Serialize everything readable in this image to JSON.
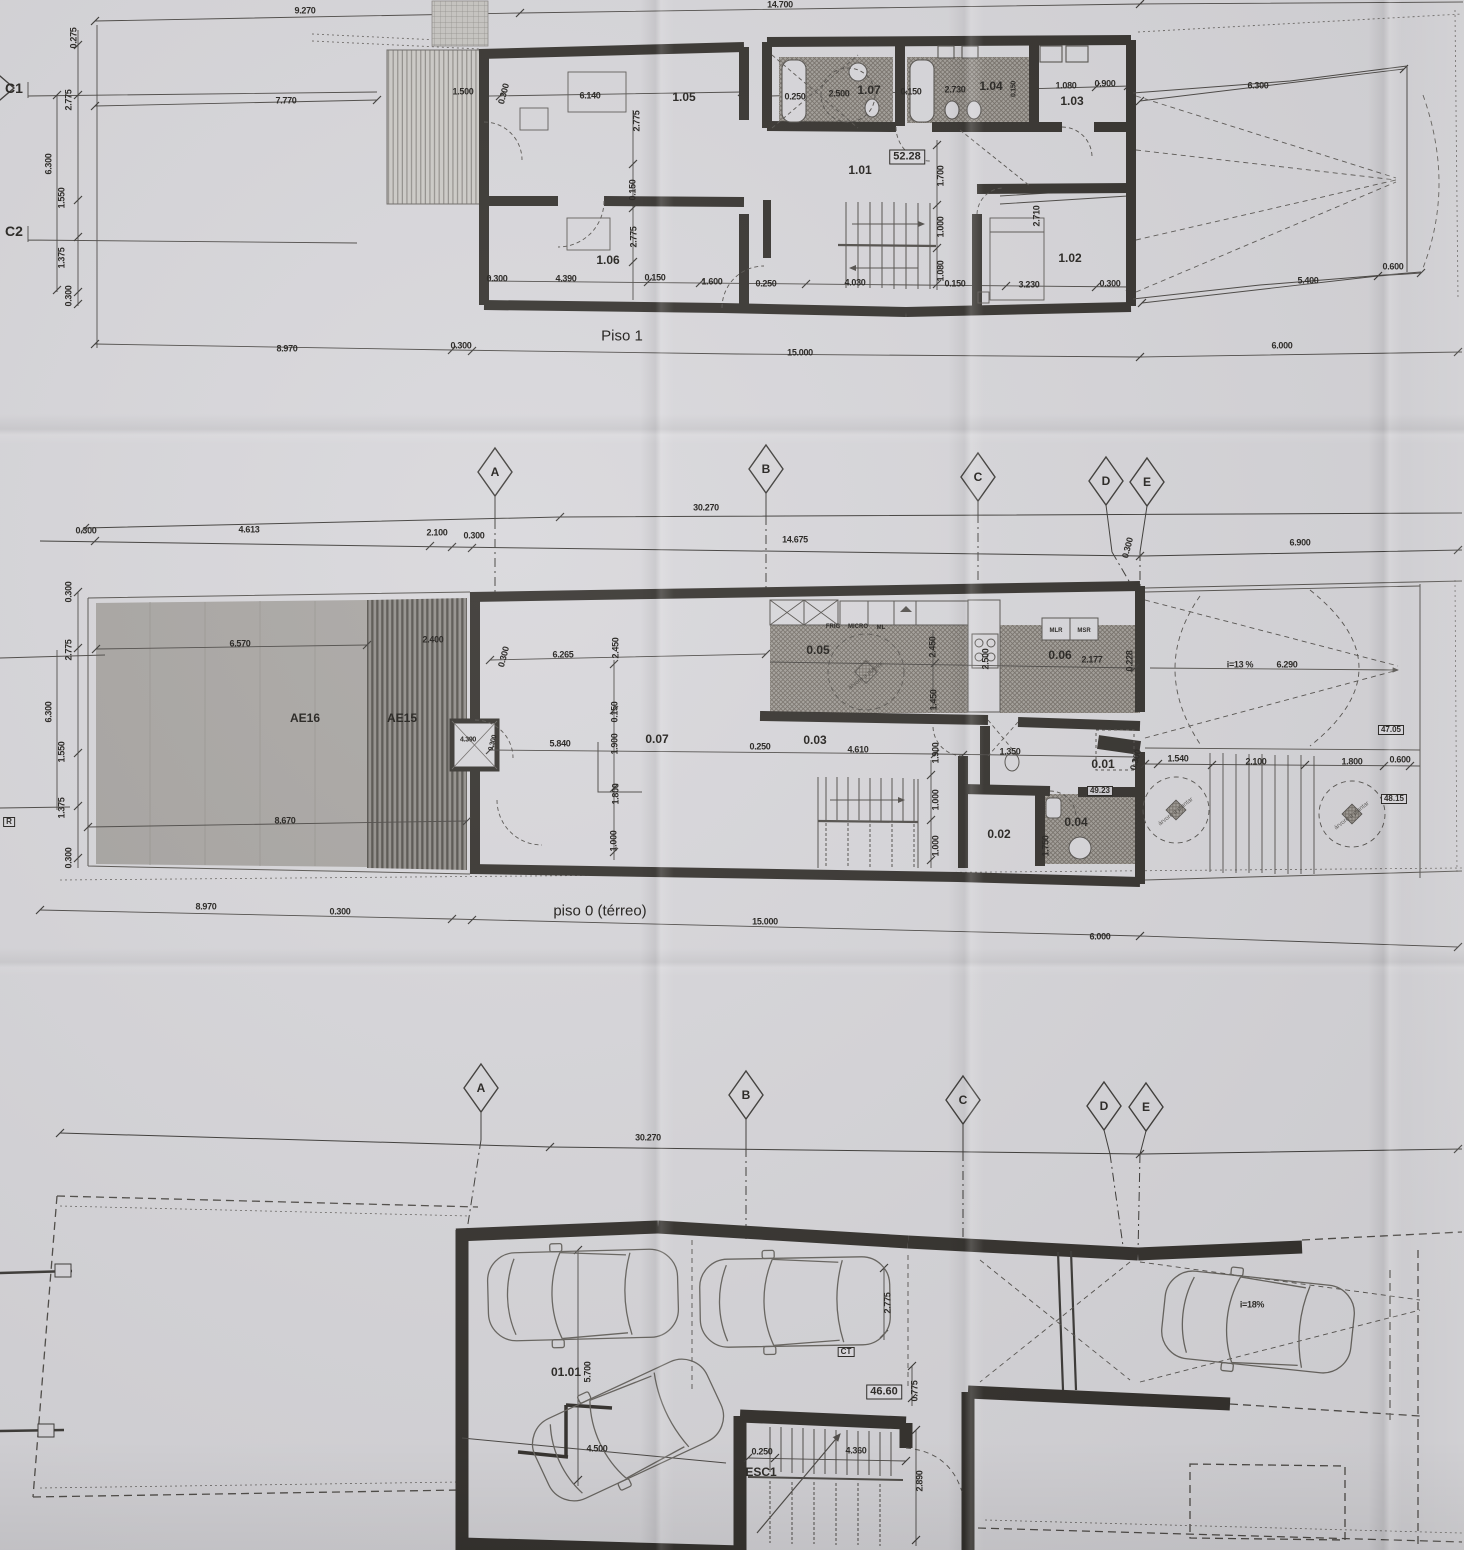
{
  "colors": {
    "paper": "#d7d6da",
    "ink": "#33302c",
    "hatch_floor": "#a19d97",
    "garden": "#a7a4a1",
    "deck_stripe": "#53504b"
  },
  "plans": {
    "piso1": {
      "title": "Piso 1",
      "labels": [
        {
          "t": "9.270",
          "x": 305,
          "y": 11
        },
        {
          "t": "14.700",
          "x": 780,
          "y": 5
        },
        {
          "t": "7.770",
          "x": 286,
          "y": 101
        },
        {
          "t": "C1",
          "x": 14,
          "y": 88,
          "c": "mark"
        },
        {
          "t": "C2",
          "x": 14,
          "y": 231,
          "c": "mark"
        },
        {
          "t": "0.275",
          "x": 74,
          "y": 38,
          "r": -90
        },
        {
          "t": "2.775",
          "x": 69,
          "y": 100,
          "r": -90
        },
        {
          "t": "6.300",
          "x": 49,
          "y": 164,
          "r": -90
        },
        {
          "t": "1.550",
          "x": 62,
          "y": 198,
          "r": -90
        },
        {
          "t": "1.375",
          "x": 62,
          "y": 258,
          "r": -90
        },
        {
          "t": "0.300",
          "x": 69,
          "y": 296,
          "r": -90
        },
        {
          "t": "1.500",
          "x": 463,
          "y": 92
        },
        {
          "t": "0.300",
          "x": 504,
          "y": 94,
          "r": -75
        },
        {
          "t": "6.140",
          "x": 590,
          "y": 96
        },
        {
          "t": "1.05",
          "x": 684,
          "y": 97,
          "c": "room"
        },
        {
          "t": "2.775",
          "x": 637,
          "y": 121,
          "r": -90
        },
        {
          "t": "0.250",
          "x": 795,
          "y": 97
        },
        {
          "t": "2.500",
          "x": 839,
          "y": 94
        },
        {
          "t": "1.07",
          "x": 869,
          "y": 90,
          "c": "room"
        },
        {
          "t": "0.150",
          "x": 911,
          "y": 92
        },
        {
          "t": "2.730",
          "x": 955,
          "y": 90
        },
        {
          "t": "1.04",
          "x": 991,
          "y": 86,
          "c": "room"
        },
        {
          "t": "0.150",
          "x": 1014,
          "y": 89,
          "r": -90,
          "c": "dims"
        },
        {
          "t": "1.080",
          "x": 1066,
          "y": 86
        },
        {
          "t": "0.900",
          "x": 1105,
          "y": 84
        },
        {
          "t": "1.03",
          "x": 1072,
          "y": 101,
          "c": "room"
        },
        {
          "t": "6.300",
          "x": 1258,
          "y": 86
        },
        {
          "t": "52.28",
          "x": 907,
          "y": 157,
          "c": "badge"
        },
        {
          "t": "1.01",
          "x": 860,
          "y": 170,
          "c": "room"
        },
        {
          "t": "1.700",
          "x": 941,
          "y": 176,
          "r": -90
        },
        {
          "t": "1.000",
          "x": 941,
          "y": 227,
          "r": -90
        },
        {
          "t": "1.080",
          "x": 941,
          "y": 271,
          "r": -90
        },
        {
          "t": "0.150",
          "x": 633,
          "y": 190,
          "r": -90
        },
        {
          "t": "2.775",
          "x": 634,
          "y": 237,
          "r": -90
        },
        {
          "t": "1.06",
          "x": 608,
          "y": 260,
          "c": "room"
        },
        {
          "t": "2.710",
          "x": 1037,
          "y": 216,
          "r": -90
        },
        {
          "t": "1.02",
          "x": 1070,
          "y": 258,
          "c": "room"
        },
        {
          "t": "0.300",
          "x": 497,
          "y": 279
        },
        {
          "t": "4.390",
          "x": 566,
          "y": 279
        },
        {
          "t": "0.150",
          "x": 655,
          "y": 278
        },
        {
          "t": "1.600",
          "x": 712,
          "y": 282
        },
        {
          "t": "0.250",
          "x": 766,
          "y": 284
        },
        {
          "t": "4.030",
          "x": 855,
          "y": 283
        },
        {
          "t": "0.150",
          "x": 955,
          "y": 284
        },
        {
          "t": "3.230",
          "x": 1029,
          "y": 285
        },
        {
          "t": "0.300",
          "x": 1110,
          "y": 284
        },
        {
          "t": "5.400",
          "x": 1308,
          "y": 281
        },
        {
          "t": "0.600",
          "x": 1393,
          "y": 267
        },
        {
          "t": "0.300",
          "x": 461,
          "y": 346
        },
        {
          "t": "8.970",
          "x": 287,
          "y": 349
        },
        {
          "t": "15.000",
          "x": 800,
          "y": 353
        },
        {
          "t": "6.000",
          "x": 1282,
          "y": 346
        }
      ]
    },
    "grid1": {
      "labels": [
        {
          "t": "A",
          "x": 495,
          "y": 472,
          "c": "axis"
        },
        {
          "t": "B",
          "x": 766,
          "y": 469,
          "c": "axis"
        },
        {
          "t": "C",
          "x": 978,
          "y": 477,
          "c": "axis"
        },
        {
          "t": "D",
          "x": 1106,
          "y": 481,
          "c": "axis"
        },
        {
          "t": "E",
          "x": 1147,
          "y": 482,
          "c": "axis"
        },
        {
          "t": "30.270",
          "x": 706,
          "y": 508
        },
        {
          "t": "0.300",
          "x": 86,
          "y": 531
        },
        {
          "t": "4.613",
          "x": 249,
          "y": 530
        },
        {
          "t": "2.100",
          "x": 437,
          "y": 533
        },
        {
          "t": "0.300",
          "x": 474,
          "y": 536
        },
        {
          "t": "14.675",
          "x": 795,
          "y": 540
        },
        {
          "t": "0.300",
          "x": 1128,
          "y": 548,
          "r": -75
        },
        {
          "t": "6.900",
          "x": 1300,
          "y": 543
        }
      ]
    },
    "piso0": {
      "title": "piso 0 (térreo)",
      "labels": [
        {
          "t": "0.300",
          "x": 69,
          "y": 592,
          "r": -90
        },
        {
          "t": "2.775",
          "x": 69,
          "y": 650,
          "r": -90
        },
        {
          "t": "6.300",
          "x": 49,
          "y": 712,
          "r": -90
        },
        {
          "t": "1.550",
          "x": 62,
          "y": 752,
          "r": -90
        },
        {
          "t": "1.375",
          "x": 62,
          "y": 808,
          "r": -90
        },
        {
          "t": "0.300",
          "x": 69,
          "y": 858,
          "r": -90
        },
        {
          "t": "R",
          "x": 9,
          "y": 822,
          "c": "bsm"
        },
        {
          "t": "6.570",
          "x": 240,
          "y": 644
        },
        {
          "t": "2.400",
          "x": 433,
          "y": 640
        },
        {
          "t": "AE16",
          "x": 305,
          "y": 718,
          "c": "room"
        },
        {
          "t": "AE15",
          "x": 402,
          "y": 718,
          "c": "room"
        },
        {
          "t": "8.670",
          "x": 285,
          "y": 821
        },
        {
          "t": "4.390",
          "x": 468,
          "y": 740,
          "c": "dims"
        },
        {
          "t": "0.300",
          "x": 493,
          "y": 743,
          "c": "dims",
          "r": -75
        },
        {
          "t": "0.300",
          "x": 504,
          "y": 657,
          "r": -75
        },
        {
          "t": "6.265",
          "x": 563,
          "y": 655
        },
        {
          "t": "2.450",
          "x": 616,
          "y": 648,
          "r": -90
        },
        {
          "t": "0.05",
          "x": 818,
          "y": 650,
          "c": "room"
        },
        {
          "t": "FRIG",
          "x": 833,
          "y": 627,
          "c": "tiny"
        },
        {
          "t": "MICRO",
          "x": 858,
          "y": 627,
          "c": "tiny"
        },
        {
          "t": "ML",
          "x": 881,
          "y": 628,
          "c": "tiny"
        },
        {
          "t": "2.450",
          "x": 933,
          "y": 647,
          "r": -90
        },
        {
          "t": "2.500",
          "x": 986,
          "y": 659,
          "r": -90
        },
        {
          "t": "0.06",
          "x": 1060,
          "y": 655,
          "c": "room"
        },
        {
          "t": "MLR",
          "x": 1056,
          "y": 631,
          "c": "tiny"
        },
        {
          "t": "MSR",
          "x": 1084,
          "y": 631,
          "c": "tiny"
        },
        {
          "t": "2.177",
          "x": 1092,
          "y": 660
        },
        {
          "t": "0.228",
          "x": 1130,
          "y": 661,
          "r": -90
        },
        {
          "t": "1.450",
          "x": 934,
          "y": 700,
          "r": -90
        },
        {
          "t": "i=13 %",
          "x": 1240,
          "y": 665
        },
        {
          "t": "6.290",
          "x": 1287,
          "y": 665
        },
        {
          "t": "47.05",
          "x": 1391,
          "y": 730,
          "c": "bsm"
        },
        {
          "t": "0.07",
          "x": 657,
          "y": 739,
          "c": "room"
        },
        {
          "t": "5.840",
          "x": 560,
          "y": 744
        },
        {
          "t": "0.150",
          "x": 615,
          "y": 712,
          "r": -90
        },
        {
          "t": "1.900",
          "x": 615,
          "y": 744,
          "r": -90
        },
        {
          "t": "1.800",
          "x": 616,
          "y": 794,
          "r": -90
        },
        {
          "t": "1.000",
          "x": 614,
          "y": 841,
          "r": -90
        },
        {
          "t": "0.250",
          "x": 760,
          "y": 747
        },
        {
          "t": "0.03",
          "x": 815,
          "y": 740,
          "c": "room"
        },
        {
          "t": "4.610",
          "x": 858,
          "y": 750
        },
        {
          "t": "1.900",
          "x": 936,
          "y": 753,
          "r": -90
        },
        {
          "t": "1.000",
          "x": 936,
          "y": 800,
          "r": -90
        },
        {
          "t": "1.000",
          "x": 936,
          "y": 846,
          "r": -90
        },
        {
          "t": "1.350",
          "x": 1010,
          "y": 752
        },
        {
          "t": "0.01",
          "x": 1103,
          "y": 764,
          "c": "room"
        },
        {
          "t": "49.23",
          "x": 1100,
          "y": 791,
          "c": "bsm"
        },
        {
          "t": "0.02",
          "x": 999,
          "y": 834,
          "c": "room"
        },
        {
          "t": "0.04",
          "x": 1076,
          "y": 822,
          "c": "room"
        },
        {
          "t": "1.750",
          "x": 1046,
          "y": 846,
          "r": -90
        },
        {
          "t": "0.300",
          "x": 1136,
          "y": 760,
          "r": -75
        },
        {
          "t": "1.540",
          "x": 1178,
          "y": 759
        },
        {
          "t": "2.100",
          "x": 1256,
          "y": 762
        },
        {
          "t": "1.800",
          "x": 1352,
          "y": 762
        },
        {
          "t": "0.600",
          "x": 1400,
          "y": 760
        },
        {
          "t": "48.15",
          "x": 1394,
          "y": 799,
          "c": "bsm"
        },
        {
          "t": "árvore a plantar",
          "x": 866,
          "y": 676,
          "c": "treelbl",
          "r": -38
        },
        {
          "t": "árvore a plantar",
          "x": 1176,
          "y": 812,
          "c": "treelbl",
          "r": -38
        },
        {
          "t": "árvore a plantar",
          "x": 1352,
          "y": 816,
          "c": "treelbl",
          "r": -38
        },
        {
          "t": "8.970",
          "x": 206,
          "y": 907
        },
        {
          "t": "0.300",
          "x": 340,
          "y": 912
        },
        {
          "t": "15.000",
          "x": 765,
          "y": 922
        },
        {
          "t": "6.000",
          "x": 1100,
          "y": 937
        }
      ]
    },
    "grid2": {
      "labels": [
        {
          "t": "A",
          "x": 481,
          "y": 1088,
          "c": "axis"
        },
        {
          "t": "B",
          "x": 746,
          "y": 1095,
          "c": "axis"
        },
        {
          "t": "C",
          "x": 963,
          "y": 1100,
          "c": "axis"
        },
        {
          "t": "D",
          "x": 1104,
          "y": 1106,
          "c": "axis"
        },
        {
          "t": "E",
          "x": 1146,
          "y": 1107,
          "c": "axis"
        },
        {
          "t": "30.270",
          "x": 648,
          "y": 1138
        }
      ]
    },
    "garage": {
      "labels": [
        {
          "t": "01.01",
          "x": 566,
          "y": 1372,
          "c": "room"
        },
        {
          "t": "5.700",
          "x": 588,
          "y": 1372,
          "r": -90
        },
        {
          "t": "4.500",
          "x": 597,
          "y": 1449
        },
        {
          "t": "2.775",
          "x": 888,
          "y": 1303,
          "r": -90
        },
        {
          "t": "CT",
          "x": 846,
          "y": 1352,
          "c": "bsm"
        },
        {
          "t": "46.60",
          "x": 884,
          "y": 1392,
          "c": "badge"
        },
        {
          "t": "0.775",
          "x": 915,
          "y": 1391,
          "r": -90
        },
        {
          "t": "0.250",
          "x": 762,
          "y": 1452
        },
        {
          "t": "4.360",
          "x": 856,
          "y": 1451
        },
        {
          "t": "ESC1",
          "x": 761,
          "y": 1472,
          "c": "room"
        },
        {
          "t": "2.890",
          "x": 920,
          "y": 1481,
          "r": -90
        },
        {
          "t": "i=18%",
          "x": 1252,
          "y": 1305
        }
      ]
    }
  }
}
